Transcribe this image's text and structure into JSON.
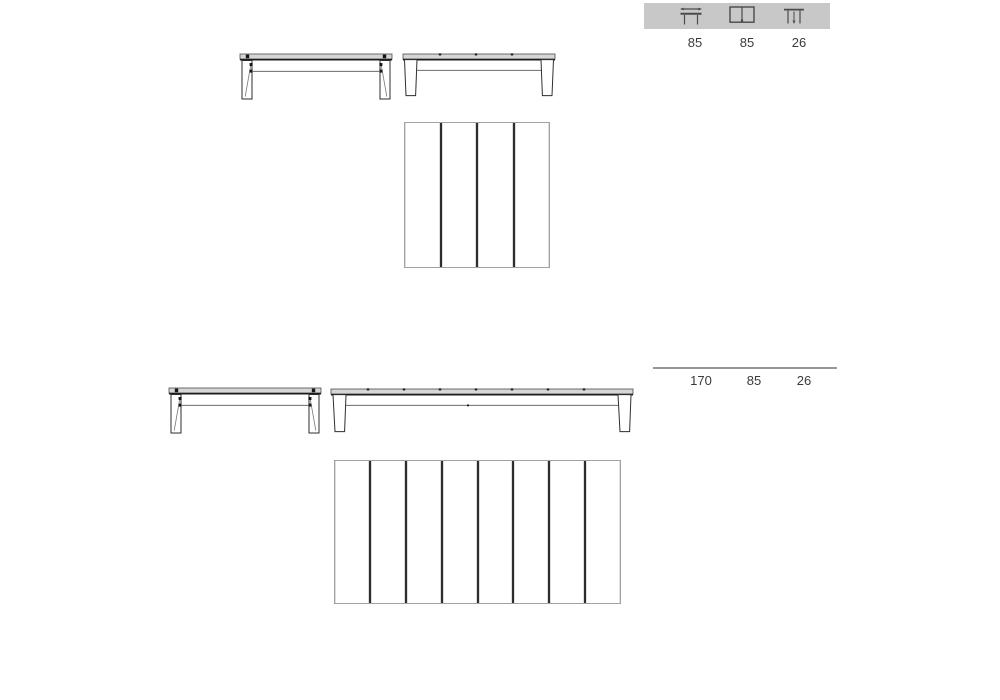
{
  "legend_bar": {
    "icons": [
      {
        "name": "closed-table-width-icon"
      },
      {
        "name": "extended-top-leaves-icon"
      },
      {
        "name": "table-height-icon"
      }
    ]
  },
  "dimensions": {
    "closed": {
      "width": "85",
      "depth": "85",
      "height": "26"
    },
    "extended": {
      "length": "170",
      "depth": "85",
      "height": "26"
    }
  },
  "drawings": {
    "closed": {
      "top_view_planks": 4
    },
    "extended": {
      "top_view_planks": 8
    }
  },
  "colors": {
    "legend_bar_bg": "#c8c8c8",
    "icon_stroke": "#4a4a4a",
    "text": "#3a3a3a",
    "outline_dark": "#2e2e2e",
    "outline_light": "#a2a2a2",
    "slab_fill": "#d6d6d6",
    "divider_dark": "#2d2d2d",
    "measure_line": "#969696",
    "background": "#ffffff"
  }
}
